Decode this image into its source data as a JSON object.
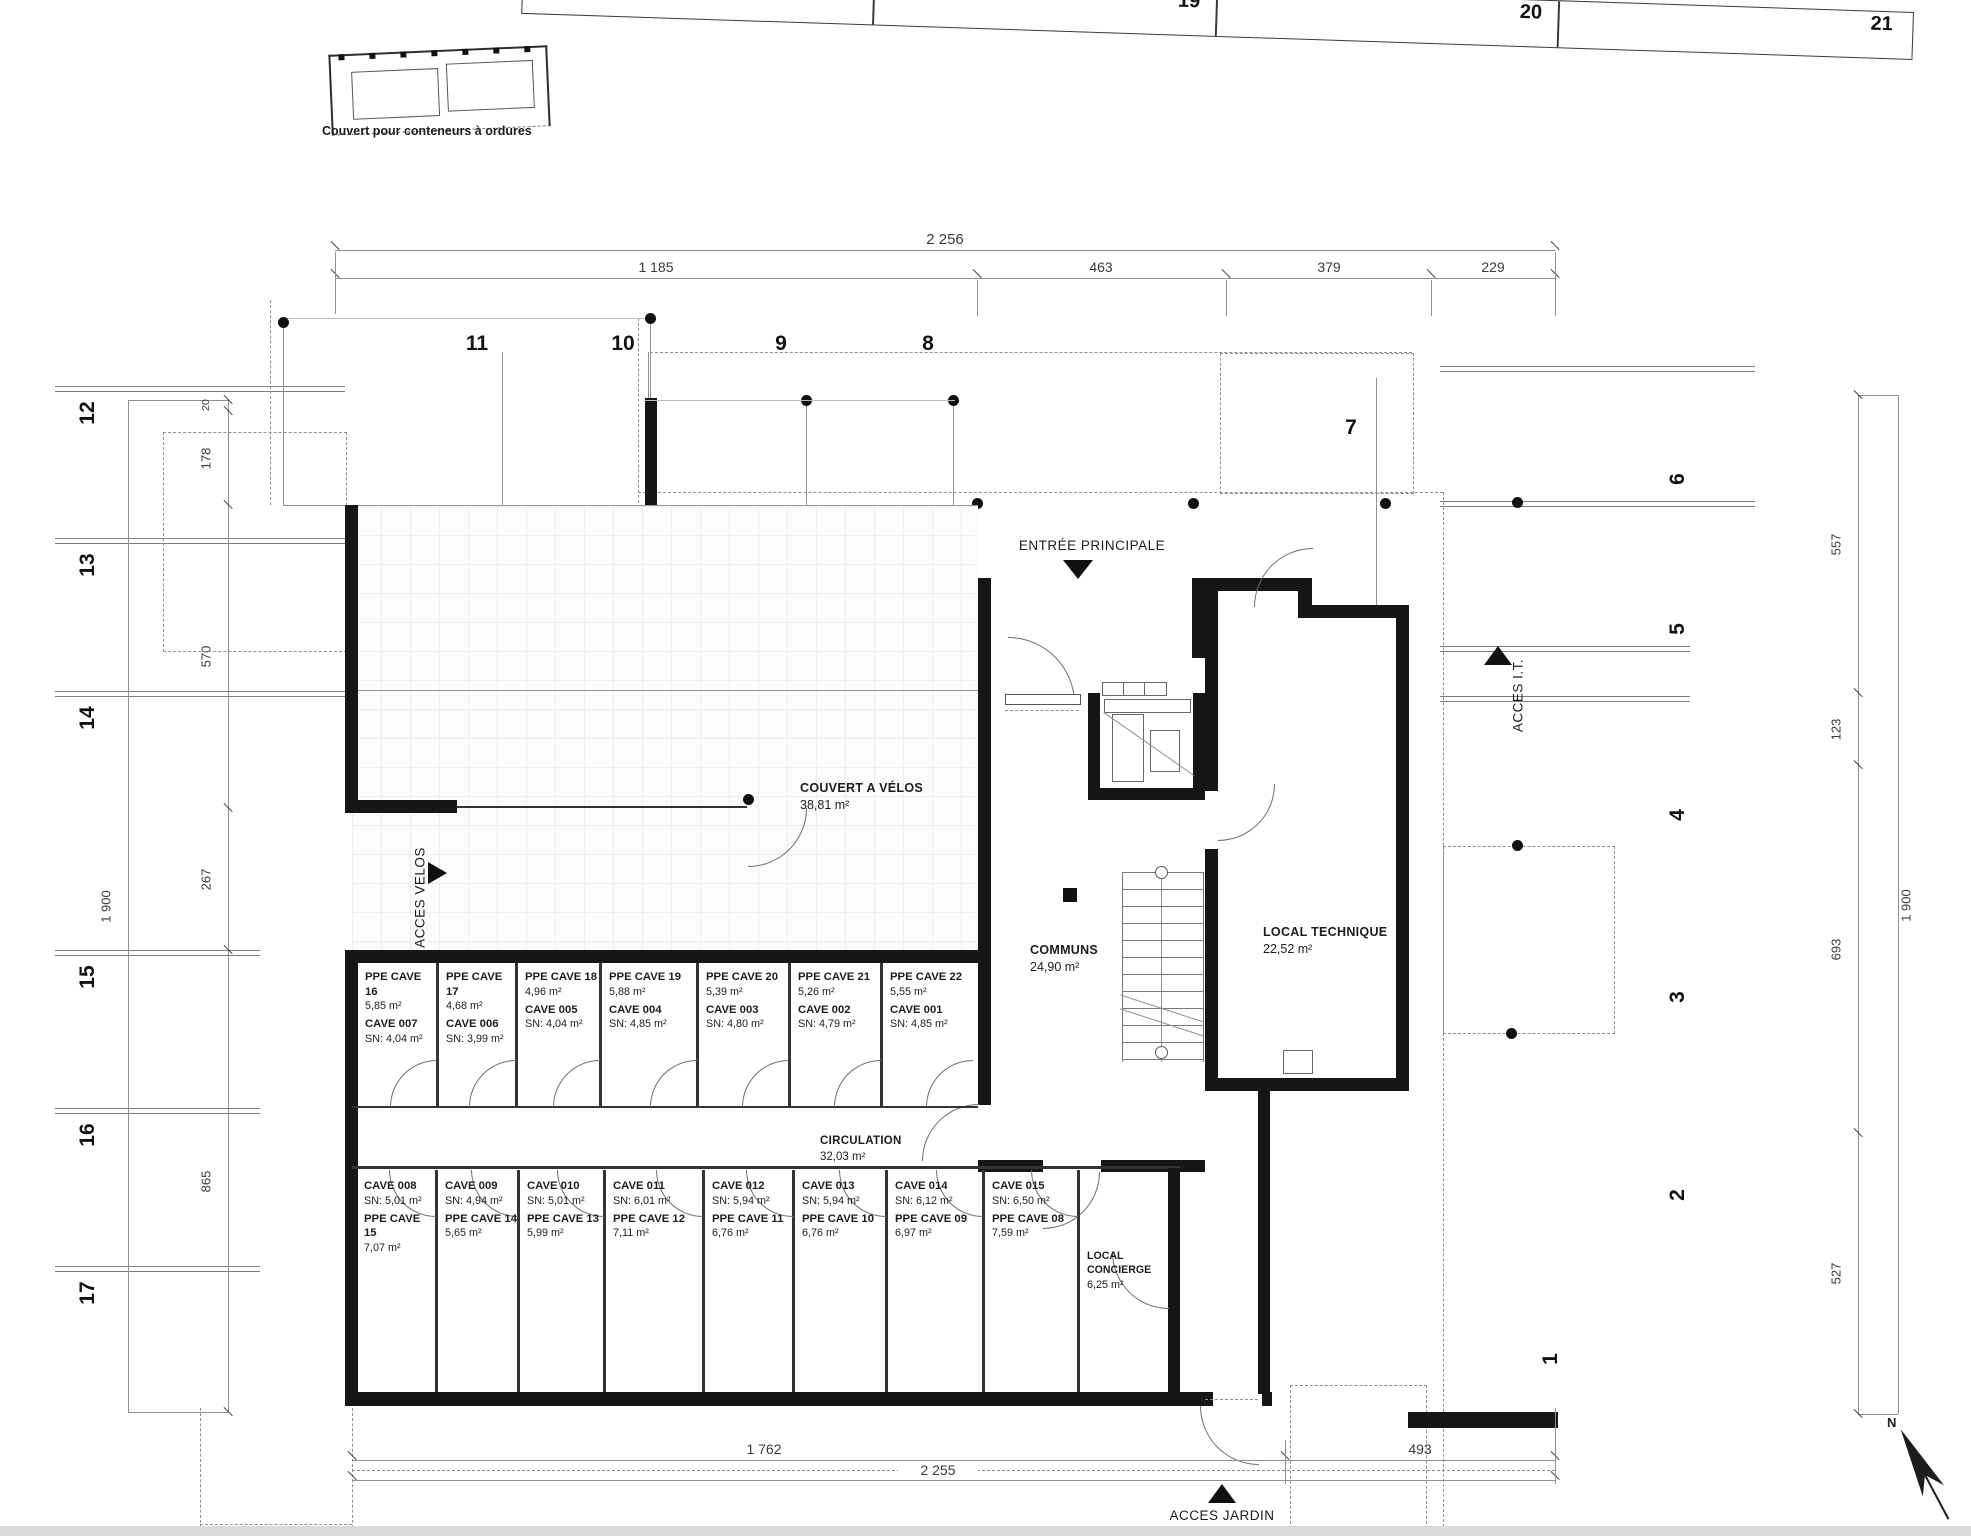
{
  "drawing": {
    "notes": {
      "conteneurs": "Couvert pour conteneurs à ordures"
    },
    "grid": {
      "top": [
        "18",
        "19",
        "20",
        "21"
      ],
      "inner": [
        "11",
        "10",
        "9",
        "8",
        "7"
      ],
      "left": [
        "12",
        "13",
        "14",
        "15",
        "16",
        "17"
      ],
      "right": [
        "6",
        "5",
        "4",
        "3",
        "2",
        "1"
      ]
    },
    "dims": {
      "top_total": "2 256",
      "top_segments": [
        "1 185",
        "463",
        "379",
        "229"
      ],
      "left_vals": [
        "20",
        "178",
        "570",
        "267",
        "865"
      ],
      "left_total": "1 900",
      "right_vals": [
        "557",
        "123",
        "693",
        "527"
      ],
      "right_total": "1 900",
      "bottom_left": "1 762",
      "bottom_right": "493",
      "bottom_total": "2 255"
    },
    "access": {
      "entree": "ENTRÉE PRINCIPALE",
      "velos": "ACCES VELOS",
      "it": "ACCES I.T.",
      "jardin": "ACCES JARDIN"
    },
    "rooms": {
      "velos": {
        "name": "COUVERT A VÉLOS",
        "area": "38,81 m²"
      },
      "communs": {
        "name": "COMMUNS",
        "area": "24,90 m²"
      },
      "technique": {
        "name": "LOCAL TECHNIQUE",
        "area": "22,52 m²"
      },
      "circulation": {
        "name": "CIRCULATION",
        "area": "32,03 m²"
      },
      "concierge": {
        "name": "LOCAL CONCIERGE",
        "area": "6,25 m²"
      }
    },
    "caves_top": [
      {
        "ppe": "PPE CAVE 16",
        "ppe_area": "5,85 m²",
        "cave": "CAVE 007",
        "sn": "SN: 4,04 m²"
      },
      {
        "ppe": "PPE CAVE 17",
        "ppe_area": "4,68 m²",
        "cave": "CAVE 006",
        "sn": "SN: 3,99 m²"
      },
      {
        "ppe": "PPE CAVE 18",
        "ppe_area": "4,96 m²",
        "cave": "CAVE 005",
        "sn": "SN: 4,04 m²"
      },
      {
        "ppe": "PPE CAVE 19",
        "ppe_area": "5,88 m²",
        "cave": "CAVE 004",
        "sn": "SN: 4,85 m²"
      },
      {
        "ppe": "PPE CAVE 20",
        "ppe_area": "5,39 m²",
        "cave": "CAVE 003",
        "sn": "SN: 4,80 m²"
      },
      {
        "ppe": "PPE CAVE 21",
        "ppe_area": "5,26 m²",
        "cave": "CAVE 002",
        "sn": "SN: 4,79 m²"
      },
      {
        "ppe": "PPE CAVE 22",
        "ppe_area": "5,55 m²",
        "cave": "CAVE 001",
        "sn": "SN: 4,85 m²"
      }
    ],
    "caves_bottom": [
      {
        "cave": "CAVE 008",
        "sn": "SN: 5,01 m²",
        "ppe": "PPE CAVE 15",
        "ppe_area": "7,07 m²"
      },
      {
        "cave": "CAVE 009",
        "sn": "SN: 4,94 m²",
        "ppe": "PPE CAVE 14",
        "ppe_area": "5,65 m²"
      },
      {
        "cave": "CAVE 010",
        "sn": "SN: 5,01 m²",
        "ppe": "PPE CAVE 13",
        "ppe_area": "5,99 m²"
      },
      {
        "cave": "CAVE 011",
        "sn": "SN: 6,01 m²",
        "ppe": "PPE CAVE 12",
        "ppe_area": "7,11 m²"
      },
      {
        "cave": "CAVE 012",
        "sn": "SN: 5,94 m²",
        "ppe": "PPE CAVE 11",
        "ppe_area": "6,76 m²"
      },
      {
        "cave": "CAVE 013",
        "sn": "SN: 5,94 m²",
        "ppe": "PPE CAVE 10",
        "ppe_area": "6,76 m²"
      },
      {
        "cave": "CAVE 014",
        "sn": "SN: 6,12 m²",
        "ppe": "PPE CAVE 09",
        "ppe_area": "6,97 m²"
      },
      {
        "cave": "CAVE 015",
        "sn": "SN: 6,50 m²",
        "ppe": "PPE CAVE 08",
        "ppe_area": "7,59 m²"
      }
    ],
    "north": "N"
  }
}
